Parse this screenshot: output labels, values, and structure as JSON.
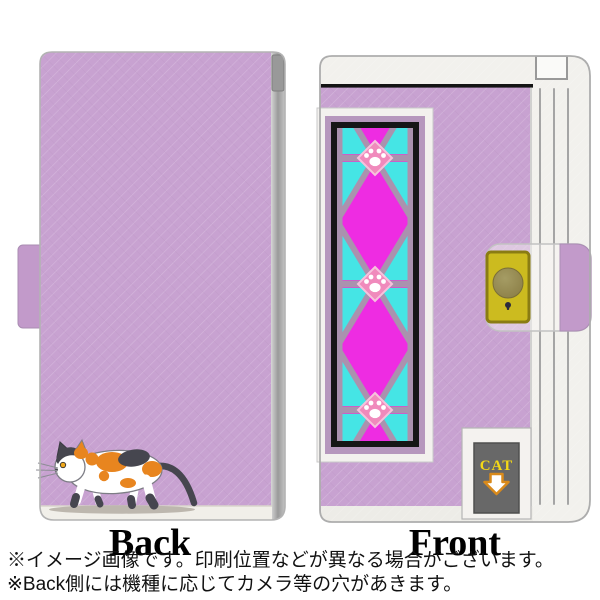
{
  "product": {
    "back_label": "Back",
    "front_label": "Front",
    "cat_tag_text": "CAT"
  },
  "notes": {
    "line1": "※イメージ画像です。印刷位置などが異なる場合がございます。",
    "line2": "※Back側には機種に応じてカメラ等の穴があきます。"
  },
  "icons": {
    "paw_print": "paw-print-icon",
    "down_arrow": "down-arrow-icon",
    "calico_cat": "calico-cat-illustration",
    "snap_button": "snap-button",
    "keyhole": "keyhole-dot-icon"
  },
  "colors": {
    "case_lilac": "#c8a2d1",
    "case_lilac_dark": "#c29aca",
    "pattern_magenta": "#ee2ce2",
    "pattern_cyan": "#45e5e5",
    "pattern_lattice": "#aa92ae",
    "paw_pink": "#f08abc",
    "snap_yellow": "#ccbb1f",
    "snap_border": "#8a7c13",
    "cat_orange": "#e8851f",
    "cat_gray": "#46464f",
    "tag_gray": "#686868",
    "tag_yellow": "#f5d916",
    "arrow_orange": "#d98a1b",
    "band_white": "#f2f1ed",
    "frame_mauve": "#b697bd"
  }
}
